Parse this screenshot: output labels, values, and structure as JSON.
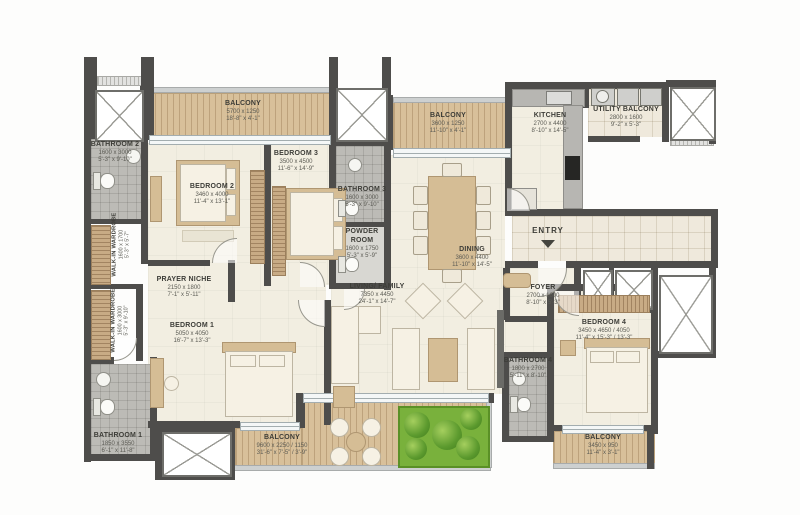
{
  "plan": {
    "type": "apartment-floor-plan",
    "entry": {
      "label": "ENTRY"
    },
    "colors": {
      "wall": "#4e4d4b",
      "floor": "#f2eee1",
      "balcony_wood": "#d8c09a",
      "bath_tile": "#bcbbb6",
      "planter_green": "#79b13c",
      "label_text": "#4a4a44"
    },
    "rooms": [
      {
        "id": "balcony-top-left",
        "name": "BALCONY",
        "mm": "5700 x 1250",
        "ft": "18'-8\" x 4'-1\""
      },
      {
        "id": "bathroom-2",
        "name": "BATHROOM 2",
        "mm": "1600 x 3000",
        "ft": "5'-3\" x 9'-10\""
      },
      {
        "id": "bedroom-2",
        "name": "BEDROOM 2",
        "mm": "3460 x 4000",
        "ft": "11'-4\" x 13'-1\""
      },
      {
        "id": "bedroom-3",
        "name": "BEDROOM 3",
        "mm": "3500 x 4500",
        "ft": "11'-6\" x 14'-9\""
      },
      {
        "id": "walk-in-wardrobe-2",
        "name": "WALK-IN WARDROBE",
        "mm": "1600 x 1700",
        "ft": "5'-3\" x 5'-7\""
      },
      {
        "id": "bathroom-3",
        "name": "BATHROOM 3",
        "mm": "1600 x 3000",
        "ft": "5'-3\" x 9'-10\""
      },
      {
        "id": "powder-room",
        "name": "POWDER ROOM",
        "mm": "1600 x 1750",
        "ft": "5'-3\" x 5'-9\""
      },
      {
        "id": "balcony-top-mid",
        "name": "BALCONY",
        "mm": "3600 x 1250",
        "ft": "11'-10\" x 4'-1\""
      },
      {
        "id": "kitchen",
        "name": "KITCHEN",
        "mm": "2700 x 4400",
        "ft": "8'-10\" x 14'-5\""
      },
      {
        "id": "utility-balcony",
        "name": "UTILITY BALCONY",
        "mm": "2800 x 1600",
        "ft": "9'-2\" x 5'-3\""
      },
      {
        "id": "dining",
        "name": "DINING",
        "mm": "3600 x 4400",
        "ft": "11'-10\" x 14'-5\""
      },
      {
        "id": "foyer",
        "name": "FOYER",
        "mm": "2700 x 1600",
        "ft": "8'-10\" x 5'-3\""
      },
      {
        "id": "prayer-niche",
        "name": "PRAYER NICHE",
        "mm": "2150 x 1800",
        "ft": "7'-1\" x 5'-11\""
      },
      {
        "id": "walk-in-wardrobe-1",
        "name": "WALK-IN WARDROBE",
        "mm": "1600 x 3000",
        "ft": "5'-3\" x 9'-10\""
      },
      {
        "id": "bedroom-1",
        "name": "BEDROOM 1",
        "mm": "5050 x 4050",
        "ft": "16'-7\" x 13'-3\""
      },
      {
        "id": "living-family",
        "name": "LIVING/ FAMILY",
        "mm": "7350 x 4450",
        "ft": "24'-1\" x 14'-7\""
      },
      {
        "id": "bedroom-4",
        "name": "BEDROOM 4",
        "mm": "3450 x 4650 / 4050",
        "ft": "11'-4\" x 15'-3\" / 13'-3\""
      },
      {
        "id": "bathroom-4",
        "name": "BATHROOM 4",
        "mm": "1800 x 2700",
        "ft": "5'-11\" x 8'-10\""
      },
      {
        "id": "bathroom-1",
        "name": "BATHROOM 1",
        "mm": "1850 x 3550",
        "ft": "6'-1\" x 11'-8\""
      },
      {
        "id": "balcony-bottom",
        "name": "BALCONY",
        "mm": "9600 x 2250 / 1150",
        "ft": "31'-6\" x 7'-5\" / 3'-9\""
      },
      {
        "id": "balcony-bottom-right",
        "name": "BALCONY",
        "mm": "3450 x 950",
        "ft": "11'-4\" x 3'-1\""
      }
    ]
  }
}
